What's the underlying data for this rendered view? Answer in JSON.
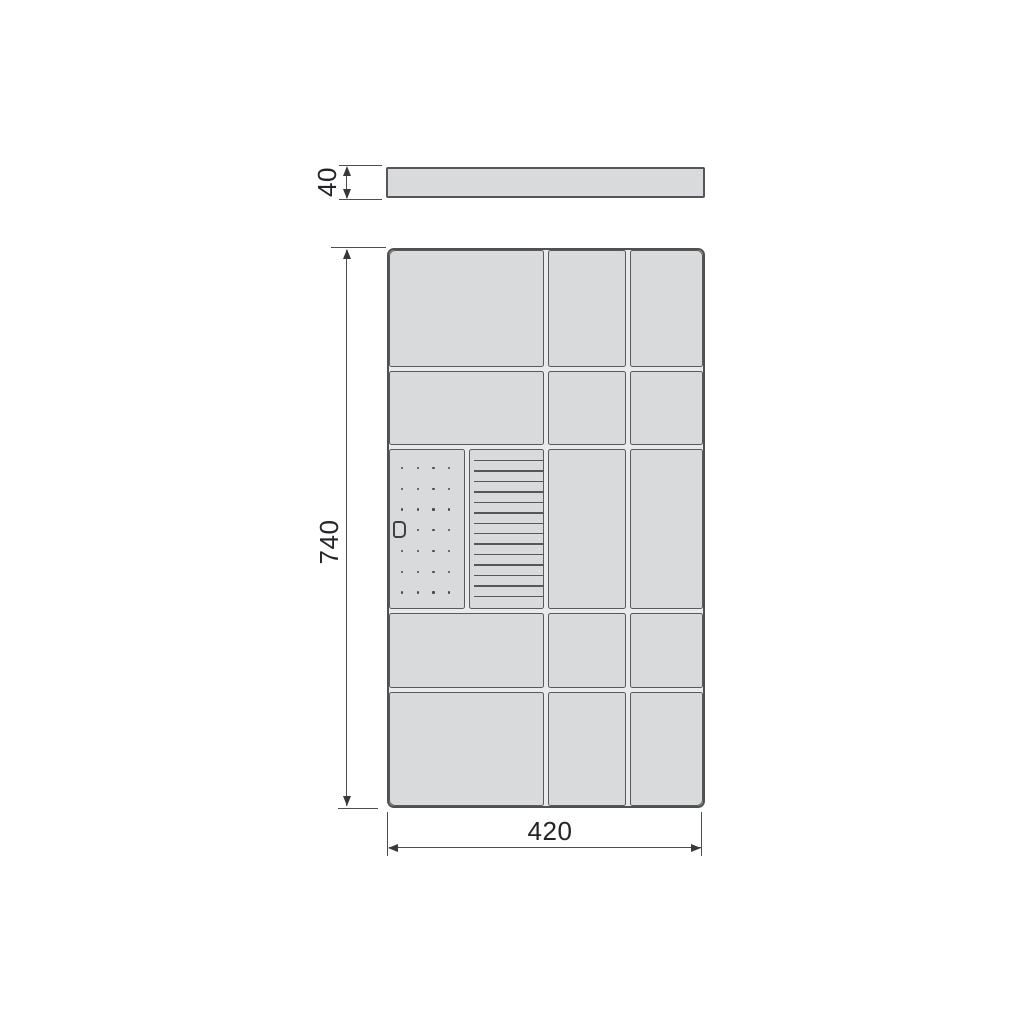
{
  "drawing": {
    "dimensions": {
      "top_panel_thickness": {
        "label": "40",
        "orientation": "vertical"
      },
      "cabinet_height": {
        "label": "740",
        "orientation": "vertical"
      },
      "cabinet_width": {
        "label": "420",
        "orientation": "horizontal"
      }
    },
    "grid": {
      "rows": 5,
      "columns": 3
    },
    "pegboard": {
      "dot_rows": 7,
      "dot_cols": 4,
      "handle_at": {
        "row": 4,
        "col": 1
      }
    },
    "slats": {
      "count": 14
    },
    "colors": {
      "background": "#ffffff",
      "cell_fill": "#d9dadb",
      "cell_border": "#595a5c",
      "panel_border": "#4f5052",
      "dimension_line": "#4c4d4f",
      "label_text": "#232427"
    }
  }
}
